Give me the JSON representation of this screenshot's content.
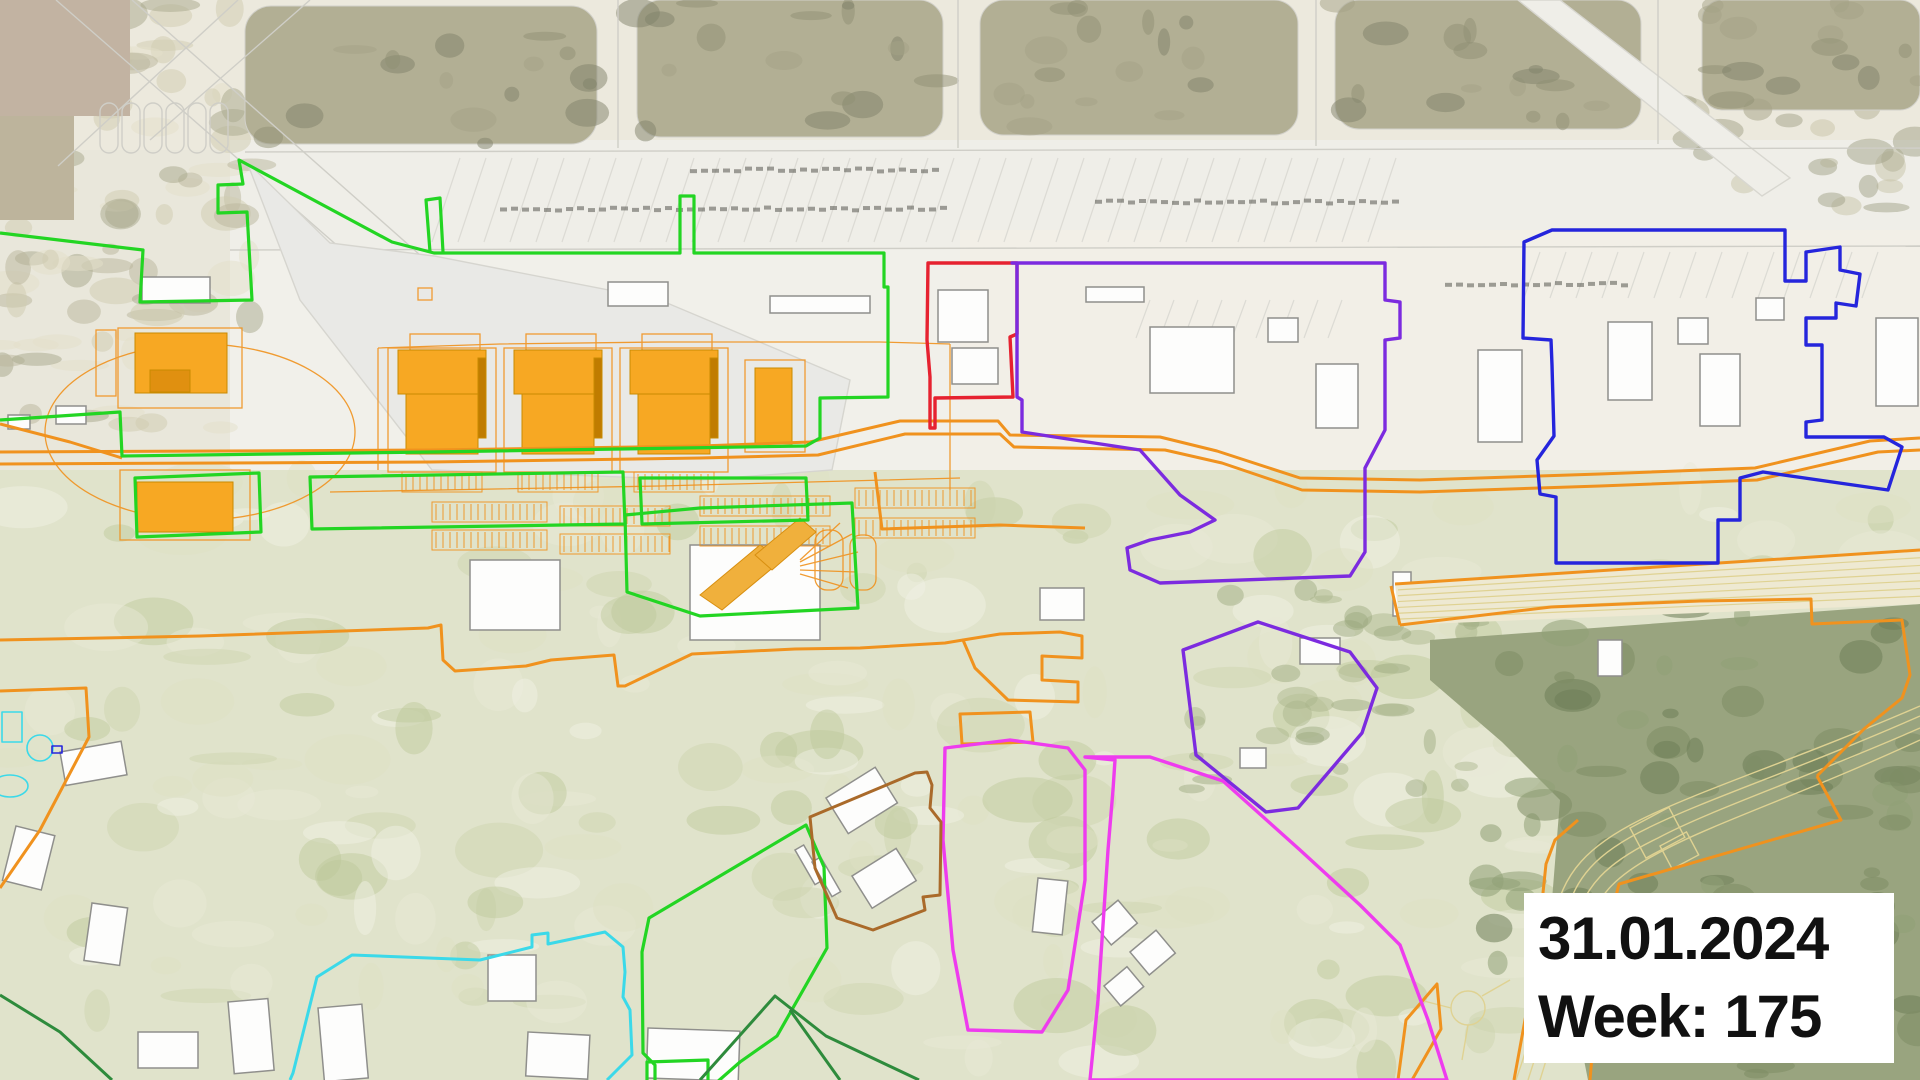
{
  "overlay": {
    "date": "31.01.2024",
    "week": "Week: 175"
  },
  "colors": {
    "perimeter_green": "#23d523",
    "dark_green": "#2e8b3c",
    "orange": "#f0921e",
    "red": "#e62230",
    "purple": "#7c2bdf",
    "blue": "#2525dc",
    "magenta": "#ee3cee",
    "cyan": "#3bd9e9",
    "brown": "#aa6a2a",
    "building_orange": "#f7a823",
    "building_orange_dark": "#d18a00",
    "white_building": "#fdfdfc",
    "vegetation": "#b2af94",
    "forest": "#99a47f",
    "road_yellow": "#dfd292",
    "date_box_bg": "#ffffff",
    "date_text": "#111111"
  },
  "zones": [
    {
      "name": "site-perimeter",
      "color_key": "perimeter_green"
    },
    {
      "name": "laydown-boundary",
      "color_key": "orange"
    },
    {
      "name": "restricted-block",
      "color_key": "red"
    },
    {
      "name": "east-campus",
      "color_key": "purple"
    },
    {
      "name": "far-east-campus",
      "color_key": "blue"
    },
    {
      "name": "south-field",
      "color_key": "magenta"
    },
    {
      "name": "southwest-field",
      "color_key": "cyan"
    },
    {
      "name": "village-block",
      "color_key": "brown"
    },
    {
      "name": "south-green-areas",
      "color_key": "dark_green"
    }
  ]
}
